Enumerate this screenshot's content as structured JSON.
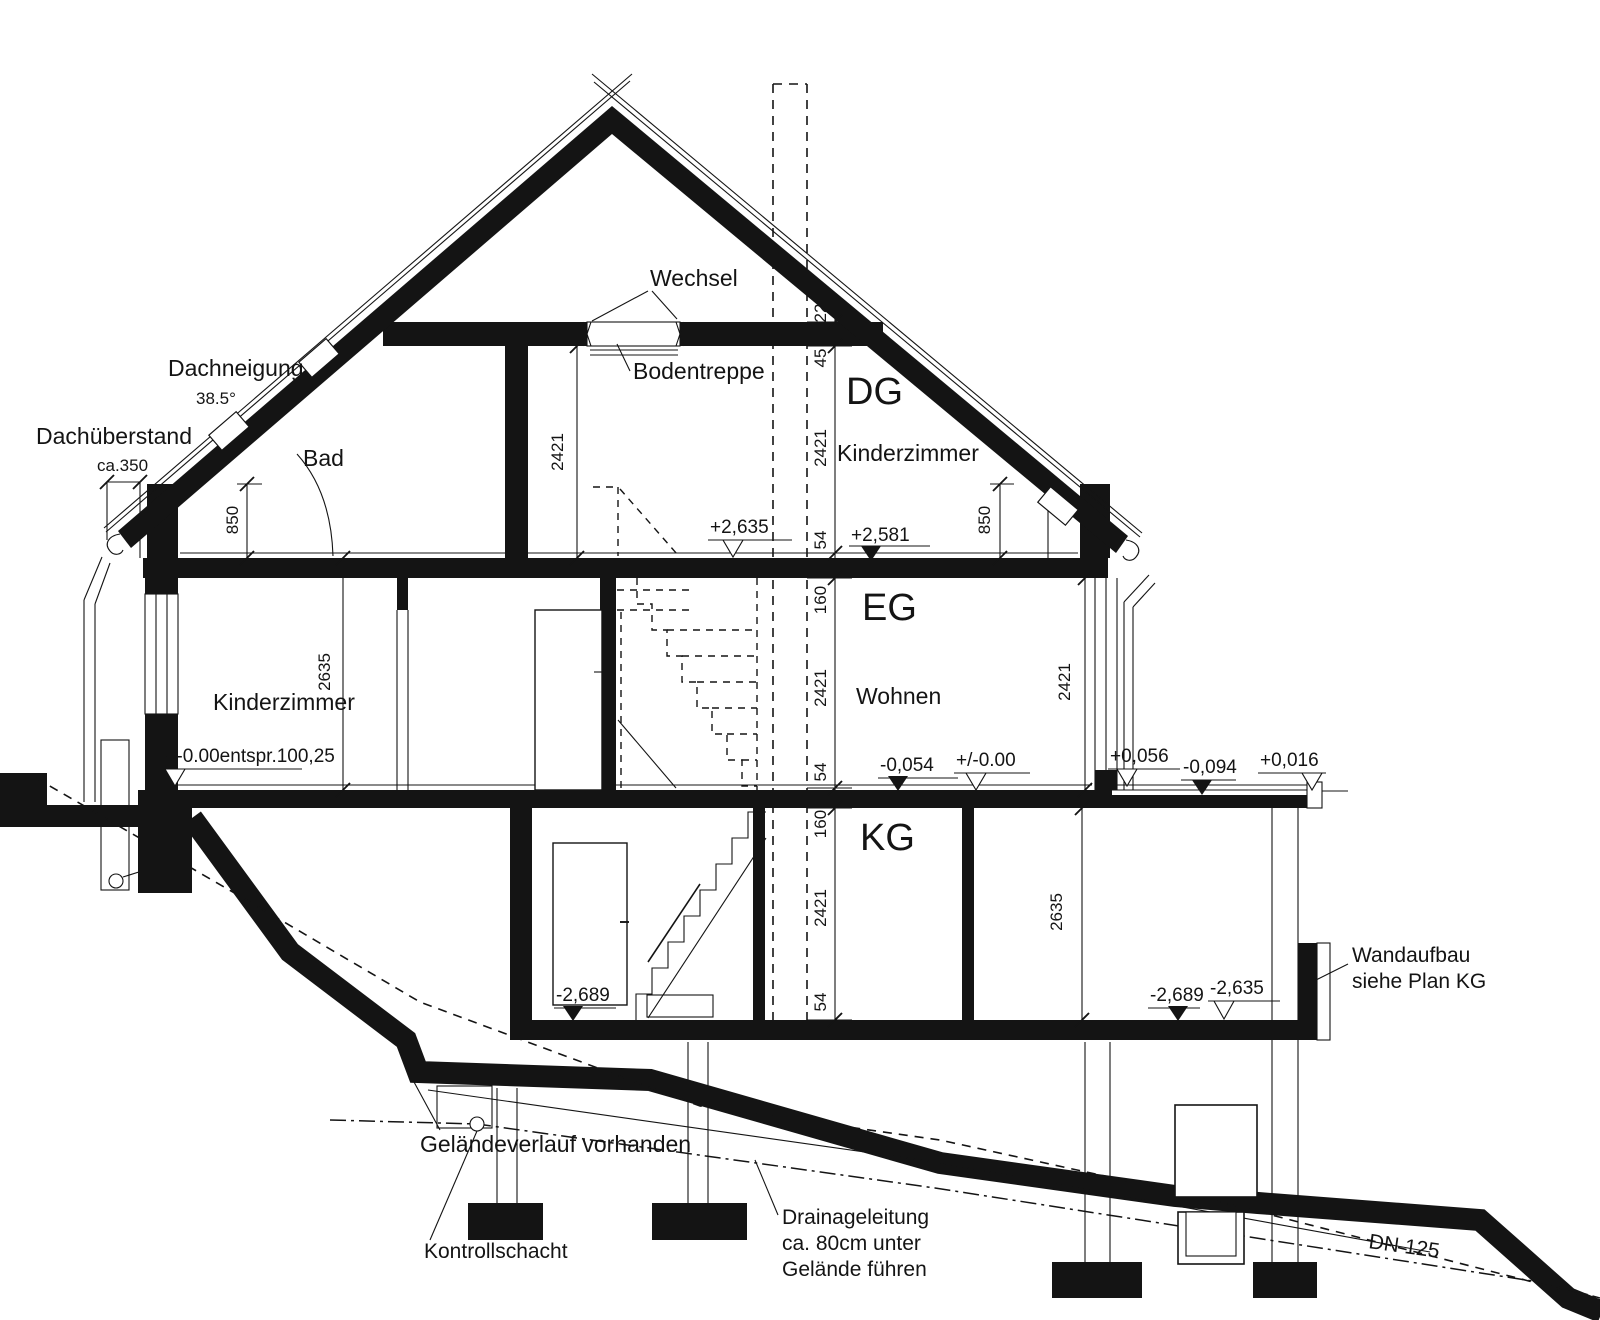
{
  "roof": {
    "dachneigung_label": "Dachneigung",
    "dachneigung_value": "38.5°",
    "dachueberstand_label": "Dachüberstand",
    "dachueberstand_value": "ca.350",
    "wechsel_label": "Wechsel",
    "bodentreppe_label": "Bodentreppe"
  },
  "floors": {
    "dg": {
      "name": "DG",
      "room": "Kinderzimmer",
      "bad": "Bad"
    },
    "eg": {
      "name": "EG",
      "room": "Wohnen",
      "room_left": "Kinderzimmer"
    },
    "kg": {
      "name": "KG"
    }
  },
  "levels": {
    "dg_ff": "+2,635",
    "dg_raw": "+2,581",
    "eg_zero_left": "+/-0.00entspr.100,25",
    "eg_raw": "-0,054",
    "eg_zero": "+/-0.00",
    "terrace_top": "+0,056",
    "terrace_raw": "-0,094",
    "terrace_end": "+0,016",
    "kg_raw_left": "-2,689",
    "kg_raw_right": "-2,689",
    "kg_ff_right": "-2,635"
  },
  "dimensions": {
    "knee_wall_left": "850",
    "knee_wall_right": "850",
    "dg_stair": "2421",
    "eg_left_room": "2635",
    "eg_right_wall": "2421",
    "kg_right_room": "2635",
    "chain": {
      "c22": "22",
      "c45": "45",
      "dg_h": "2421",
      "dg_screed": "54",
      "eg_slab": "160",
      "eg_h": "2421",
      "eg_screed": "54",
      "kg_slab": "160",
      "kg_h": "2421",
      "kg_screed": "54"
    }
  },
  "site": {
    "gelaende": "Geländeverlauf vorhanden",
    "kontrollschacht": "Kontrollschacht",
    "drainage1": "Drainageleitung",
    "drainage2": "ca. 80cm unter",
    "drainage3": "Gelände führen",
    "dn": "DN 125",
    "wandaufbau1": "Wandaufbau",
    "wandaufbau2": "siehe Plan KG"
  }
}
